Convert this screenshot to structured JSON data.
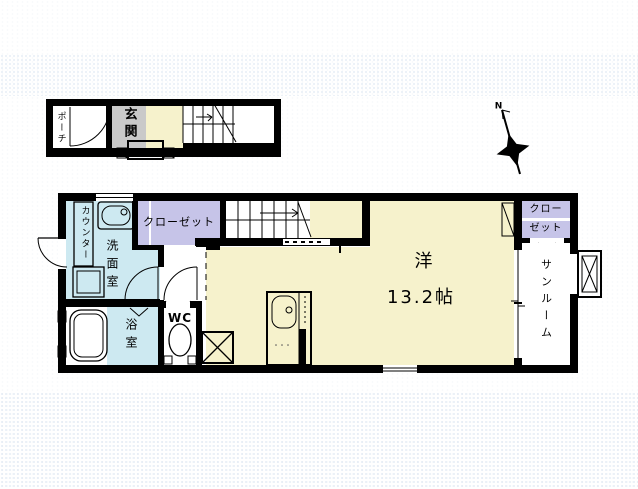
{
  "colors": {
    "wall": "#000000",
    "white": "#ffffff",
    "yellow": "#f6f2cc",
    "blue": "#cde9f1",
    "purple": "#c6c4e8",
    "gray": "#c9c9c9"
  },
  "floor1": {
    "porch": "ポーチ",
    "entrance": "玄関"
  },
  "floor2": {
    "counter": "カウンター",
    "washroom": "洗面室",
    "closet_left": "クローゼット",
    "bath": "浴室",
    "wc": "WC",
    "room_name": "洋",
    "room_size": "13.2帖",
    "closet_right_line1": "クロー",
    "closet_right_line2": "ゼット",
    "sunroom": "サンルーム"
  },
  "compass": {
    "north": "N"
  }
}
